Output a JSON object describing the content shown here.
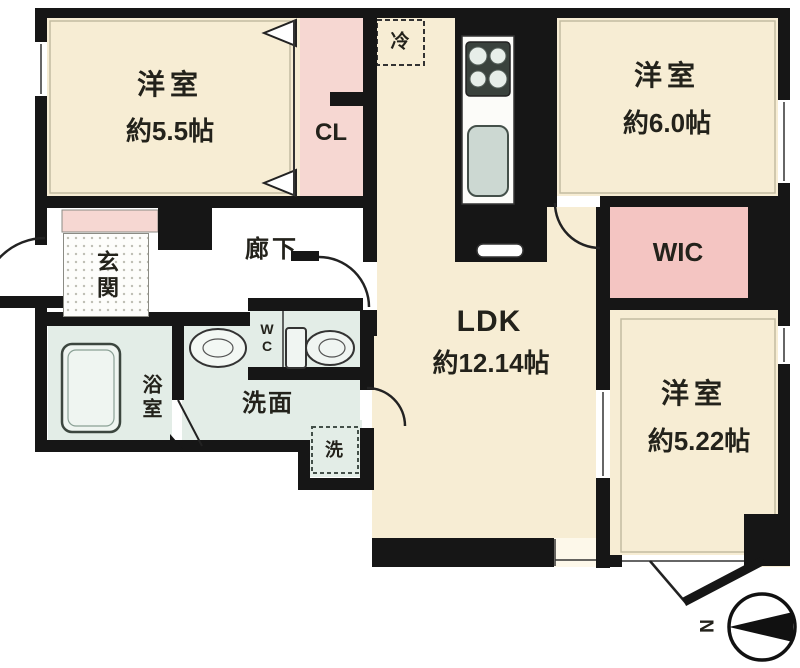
{
  "rooms": {
    "bedroom1": {
      "name": "洋室",
      "size": "約5.5帖"
    },
    "bedroom2": {
      "name": "洋室",
      "size": "約6.0帖"
    },
    "bedroom3": {
      "name": "洋室",
      "size": "約5.22帖"
    },
    "ldk": {
      "name": "LDK",
      "size": "約12.14帖"
    },
    "closet": {
      "label": "CL"
    },
    "wic": {
      "label": "WIC"
    },
    "hallway": {
      "label": "廊下"
    },
    "entrance": {
      "label": "玄関"
    },
    "bathroom": {
      "label": "浴室"
    },
    "washroom": {
      "label": "洗面"
    },
    "toilet": {
      "label": "WC"
    },
    "laundry": {
      "label": "洗"
    },
    "refrigerator": {
      "label": "冷"
    }
  },
  "compass": {
    "north_label": "N"
  },
  "colors": {
    "wall": "#161616",
    "room_fill": "#f7edd4",
    "closet_fill": "#f6d7d2",
    "wic_fill": "#f4c5c2",
    "wet_area_fill": "#e3ede7",
    "fixture_fill": "#eff5f1"
  }
}
